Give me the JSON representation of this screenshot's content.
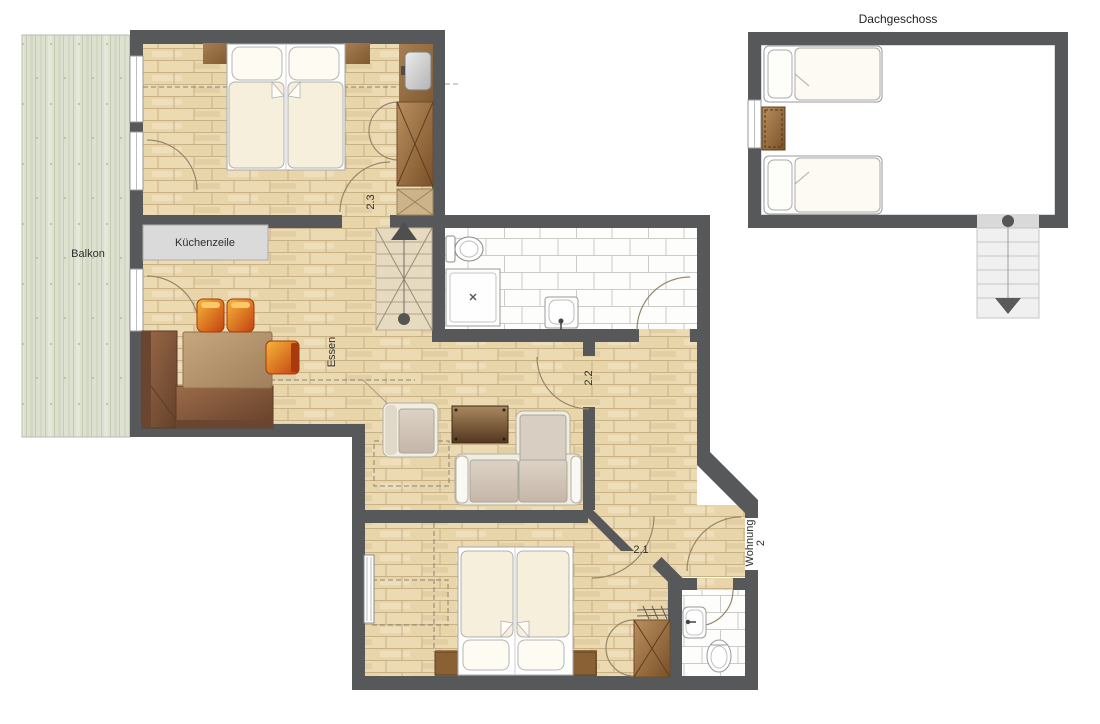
{
  "floorplan": {
    "labels": {
      "balcony": "Balkon",
      "kitchen_unit": "Küchenzeile",
      "dining": "Essen",
      "room_2_3": "2.3",
      "room_2_2": "2.2",
      "room_2_1": "2.1",
      "apartment_line1": "Wohnung",
      "apartment_line2": "2",
      "attic": "Dachgeschoss"
    },
    "colors": {
      "wall": "#57585a",
      "wood_floor": "#ecdab3",
      "balcony_deck": "#dde1d0",
      "tile_room": "#fdfdfc",
      "furniture_brown": "#8a6134",
      "bench_brown": "#7a4c33",
      "chair_orange": "#d9541a",
      "kitchen_counter": "#dadada",
      "bed_linen": "#f6efdb",
      "stair_symbol": "#4f4f4f"
    }
  }
}
